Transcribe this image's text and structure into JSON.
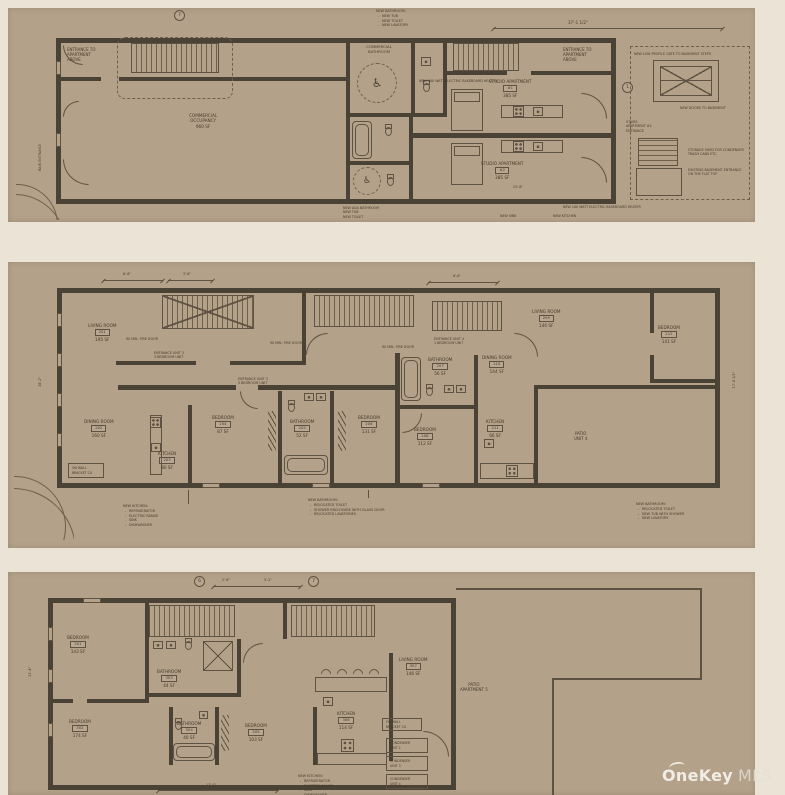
{
  "watermark": {
    "brand": "OneKey",
    "suffix": "MLS"
  },
  "plan1": {
    "dims": {
      "top": "37'-1 1/2\"",
      "bottom": "25'-8\""
    },
    "tags": {
      "t1": "7",
      "t2": "1"
    },
    "labels": {
      "entrance_left": {
        "l1": "ENTRANCE TO",
        "l2": "APARTMENT",
        "l3": "ABOVE"
      },
      "entrance_right": {
        "l1": "ENTRANCE TO",
        "l2": "APARTMENT",
        "l3": "ABOVE"
      },
      "commercial": {
        "l1": "COMMERCIAL",
        "l2": "OCCUPANCY",
        "area": "960 SF"
      },
      "comm_bath": {
        "l1": "COMMERCIAL",
        "l2": "BATHROOM"
      },
      "studio1": {
        "name": "STUDIO APARTMENT",
        "num": "#1",
        "area": "385 SF"
      },
      "studio2": {
        "name": "STUDIO APARTMENT",
        "num": "#2",
        "area": "385 SF"
      },
      "stairs_apt2": {
        "l1": "STAIRS",
        "l2": "APARTMENT #2",
        "l3": "ENTRANCE"
      },
      "main_entrance": "MAIN ENTRANCE"
    },
    "notes": {
      "bath_top": {
        "title": "NEW BATHROOM:",
        "b1": "NEW TUB",
        "b2": "NEW TOILET",
        "b3": "NEW LAVATORY"
      },
      "basement_gate": "NEW LOW PROFILE GATE TO BASEMENT STEPS",
      "doors_basement": "NEW DOORS TO BASEMENT",
      "shed": {
        "l1": "STORAGE SHED FOR CONDENSER",
        "l2": "TRASH CANS ETC."
      },
      "basement_entrance": {
        "l1": "EXISTING BASEMENT ENTRANCE",
        "l2": "ON THE FLAT TOP"
      },
      "ada": {
        "l1": "NEW ADA BATHROOM",
        "l2": "NEW TUB",
        "l3": "NEW TOILET"
      },
      "sink": "NEW SINK",
      "kitchen": "NEW KITCHEN",
      "heater": "NEW 100 WATT ELECTRIC BASEBOARD HEATER"
    }
  },
  "plan2": {
    "dims": {
      "left": "38'-2\"",
      "t1": "6'-6\"",
      "t2": "3'-6\"",
      "t3": "8'-6\"",
      "right": "17'-8 1/2\""
    },
    "rooms": {
      "living1": {
        "name": "LIVING ROOM",
        "num": "201",
        "area": "195 SF"
      },
      "dining1": {
        "name": "DINING ROOM",
        "num": "202",
        "area": "160 SF"
      },
      "kitchen1": {
        "name": "KITCHEN",
        "num": "203",
        "area": "80 SF"
      },
      "bed1": {
        "name": "BEDROOM",
        "num": "204",
        "area": "87 SF"
      },
      "bath1": {
        "name": "BATHROOM",
        "num": "205",
        "area": "52 SF"
      },
      "bed2": {
        "name": "BEDROOM",
        "num": "206",
        "area": "131 SF"
      },
      "bath2": {
        "name": "BATHROOM",
        "num": "207",
        "area": "56 SF"
      },
      "bed3": {
        "name": "BEDROOM",
        "num": "208",
        "area": "112 SF"
      },
      "living2": {
        "name": "LIVING ROOM",
        "num": "209",
        "area": "146 SF"
      },
      "dining2": {
        "name": "DINING ROOM",
        "num": "210",
        "area": "144 SF"
      },
      "kitchen2": {
        "name": "KITCHEN",
        "num": "211",
        "area": "66 SF"
      },
      "bed4": {
        "name": "BEDROOM",
        "num": "212",
        "area": "141 SF"
      }
    },
    "patio": {
      "l1": "PATIO",
      "l2": "UNIT 4"
    },
    "fire_door": "90 MIN. FIRE DOOR",
    "entr1": {
      "l1": "ENTRANCE UNIT 3",
      "l2": "3 BEDROOM UNIT"
    },
    "entr2": {
      "l1": "ENTRANCE UNIT 3",
      "l2": "3 BEDROOM UNIT"
    },
    "entr3": {
      "l1": "ENTRANCE UNIT 4",
      "l2": "1 BEDROOM UNIT"
    },
    "bracket": {
      "l1": "ON WALL",
      "l2": "BRACKET CU"
    },
    "notes": {
      "kitchen": {
        "title": "NEW KITCHEN:",
        "b1": "REFRIGERATOR",
        "b2": "ELECTRIC RANGE",
        "b3": "SINK",
        "b4": "DISHWASHER"
      },
      "bath_c": {
        "title": "NEW BATHROOM:",
        "b1": "RELOCATED TOILET",
        "b2": "SHOWER ENCLOSURE WITH GLASS DOOR",
        "b3": "RELOCATED LAVATORIES"
      },
      "bath_r": {
        "title": "NEW BATHROOM:",
        "b1": "RELOCATED TOILET",
        "b2": "NEW TUB WITH SHOWER",
        "b3": "NEW LAVATORY"
      }
    }
  },
  "plan3": {
    "dims": {
      "d1": "2'-8\"",
      "d2": "5'-2\"",
      "left": "31'-4\"",
      "bottom": "17'-0\""
    },
    "tags": {
      "t1": "6",
      "t2": "7"
    },
    "rooms": {
      "bed1": {
        "name": "BEDROOM",
        "num": "301",
        "area": "143 SF"
      },
      "bed2": {
        "name": "BEDROOM",
        "num": "302",
        "area": "174 SF"
      },
      "bath1": {
        "name": "BATHROOM",
        "num": "303",
        "area": "44 SF"
      },
      "bath2": {
        "name": "BATHROOM",
        "num": "304",
        "area": "40 SF"
      },
      "bed3": {
        "name": "BEDROOM",
        "num": "305",
        "area": "103 SF"
      },
      "kitchen": {
        "name": "KITCHEN",
        "num": "306",
        "area": "114 SF"
      },
      "living": {
        "name": "LIVING ROOM",
        "num": "307",
        "area": "146 SF"
      }
    },
    "patio": {
      "l1": "PATIO",
      "l2": "APARTMENT 5"
    },
    "condensers": {
      "c1": {
        "l1": "CONDENSER",
        "l2": "UNIT 2"
      },
      "c2": {
        "l1": "CONDENSER",
        "l2": "UNIT 3"
      },
      "c3": {
        "l1": "CONDENSER",
        "l2": "UNIT 4"
      }
    },
    "bracket": {
      "l1": "ON WALL",
      "l2": "BRACKET CU"
    },
    "notes": {
      "kitchen": {
        "title": "NEW KITCHEN:",
        "b1": "REFRIGERATOR",
        "b2": "ELECTRIC RANGE",
        "b3": "SINK",
        "b4": "DISHWASHER"
      }
    }
  }
}
